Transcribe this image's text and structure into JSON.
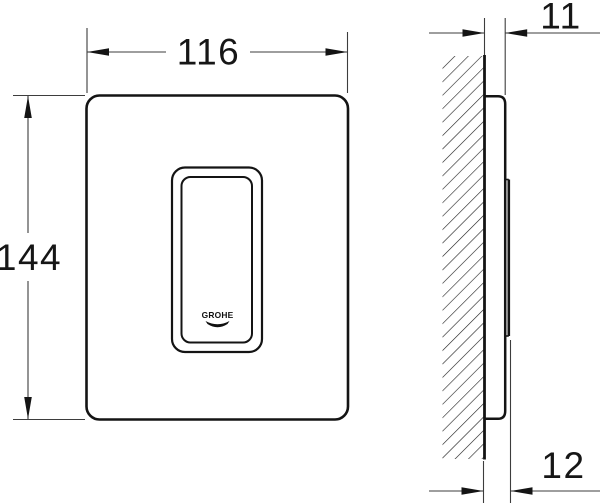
{
  "drawing": {
    "brand_logo_text": "GROHE",
    "colors": {
      "outline": "#141414",
      "dimension_line": "#3d3d3d",
      "text": "#161616",
      "background": "#ffffff"
    },
    "dimension_labels": {
      "plate_width": "116",
      "plate_height": "144",
      "depth_top": "11",
      "depth_bottom": "12"
    }
  }
}
